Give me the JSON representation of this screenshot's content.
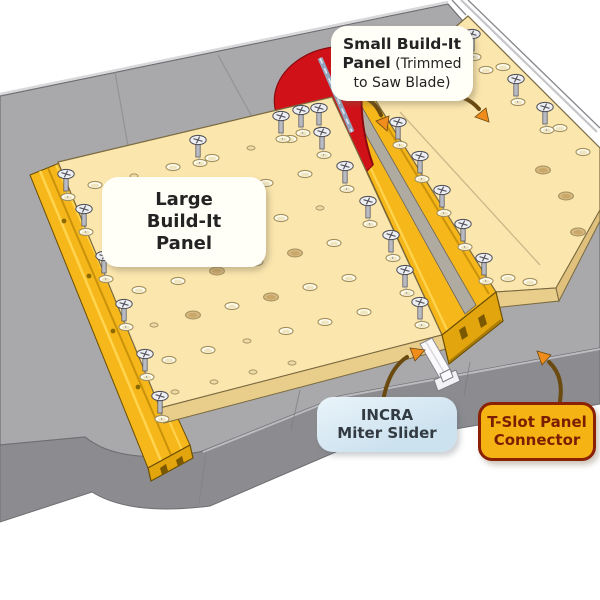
{
  "title": "INCRA Build-It System table saw sled diagram",
  "callouts": {
    "small_panel": {
      "bold": "Small Build-It Panel",
      "rest": " (Trimmed to Saw Blade)"
    },
    "large_panel": {
      "text": "Large\nBuild-It\nPanel"
    },
    "miter_slider": {
      "text": "INCRA\nMiter Slider"
    },
    "tslot_connector": {
      "text": "T-Slot Panel\nConnector"
    }
  },
  "colors": {
    "background": "#ffffff",
    "table_top": "#a9a9ab",
    "table_face": "#8c8c90",
    "table_line": "#6f6f73",
    "table_hilite": "#d8d8db",
    "panel": "#fbe6ad",
    "panel_edge": "#e9cd8b",
    "panel_edge_dark": "#dfc07c",
    "panel_line": "#7a6a40",
    "gold": "#f6b71b",
    "gold_light": "#ffd44f",
    "gold_dark": "#c9920a",
    "gold_face": "#e2a50d",
    "gold_line": "#6b4e00",
    "red": "#d01218",
    "red_dark": "#8a0a10",
    "blade": "#94a6be",
    "slider_white": "#fafafc",
    "channel_gray": "#b0aba0",
    "arrow": "#f08c1c",
    "arrow_dark": "#6b4a10",
    "label_blue": "#cde2ef",
    "label_blue_hi": "#eaf4fa",
    "label_gold": "#f6b414",
    "label_gold_border": "#8b2104",
    "label_gold_text": "#7a1d00",
    "hole_open_fill": "#fffdf0",
    "hole_plug_fill": "#d8b982",
    "hole_rim": "#a3905c"
  },
  "scene": {
    "screws": [
      [
        66,
        170
      ],
      [
        84,
        205
      ],
      [
        104,
        252
      ],
      [
        124,
        300
      ],
      [
        145,
        350
      ],
      [
        160,
        392
      ],
      [
        198,
        136
      ],
      [
        281,
        112
      ],
      [
        301,
        106
      ],
      [
        319,
        104
      ],
      [
        322,
        128
      ],
      [
        345,
        162
      ],
      [
        368,
        197
      ],
      [
        391,
        231
      ],
      [
        405,
        266
      ],
      [
        420,
        298
      ],
      [
        398,
        118
      ],
      [
        420,
        152
      ],
      [
        442,
        186
      ],
      [
        463,
        220
      ],
      [
        484,
        254
      ],
      [
        472,
        30
      ],
      [
        516,
        75
      ],
      [
        545,
        103
      ]
    ],
    "holes_open": [
      [
        95,
        185
      ],
      [
        173,
        167
      ],
      [
        212,
        158
      ],
      [
        290,
        139
      ],
      [
        149,
        211
      ],
      [
        188,
        202
      ],
      [
        266,
        183
      ],
      [
        305,
        174
      ],
      [
        125,
        255
      ],
      [
        203,
        236
      ],
      [
        281,
        218
      ],
      [
        139,
        290
      ],
      [
        178,
        281
      ],
      [
        256,
        262
      ],
      [
        334,
        243
      ],
      [
        232,
        306
      ],
      [
        310,
        287
      ],
      [
        349,
        278
      ],
      [
        169,
        360
      ],
      [
        208,
        350
      ],
      [
        286,
        331
      ],
      [
        325,
        322
      ],
      [
        364,
        312
      ],
      [
        486,
        70
      ],
      [
        503,
        67
      ],
      [
        560,
        128
      ],
      [
        583,
        152
      ],
      [
        508,
        278
      ],
      [
        530,
        282
      ]
    ],
    "holes_plug": [
      [
        227,
        192
      ],
      [
        164,
        246
      ],
      [
        242,
        227
      ],
      [
        217,
        271
      ],
      [
        295,
        253
      ],
      [
        193,
        315
      ],
      [
        271,
        297
      ],
      [
        543,
        170
      ],
      [
        566,
        196
      ],
      [
        578,
        232
      ]
    ],
    "holes_small": [
      [
        134,
        176
      ],
      [
        251,
        148
      ],
      [
        110,
        220
      ],
      [
        320,
        208
      ],
      [
        154,
        325
      ],
      [
        247,
        341
      ],
      [
        175,
        392
      ],
      [
        214,
        382
      ],
      [
        253,
        372
      ],
      [
        292,
        363
      ]
    ],
    "rivets": [
      [
        64,
        221
      ],
      [
        89,
        276
      ],
      [
        113,
        331
      ],
      [
        138,
        387
      ]
    ]
  }
}
